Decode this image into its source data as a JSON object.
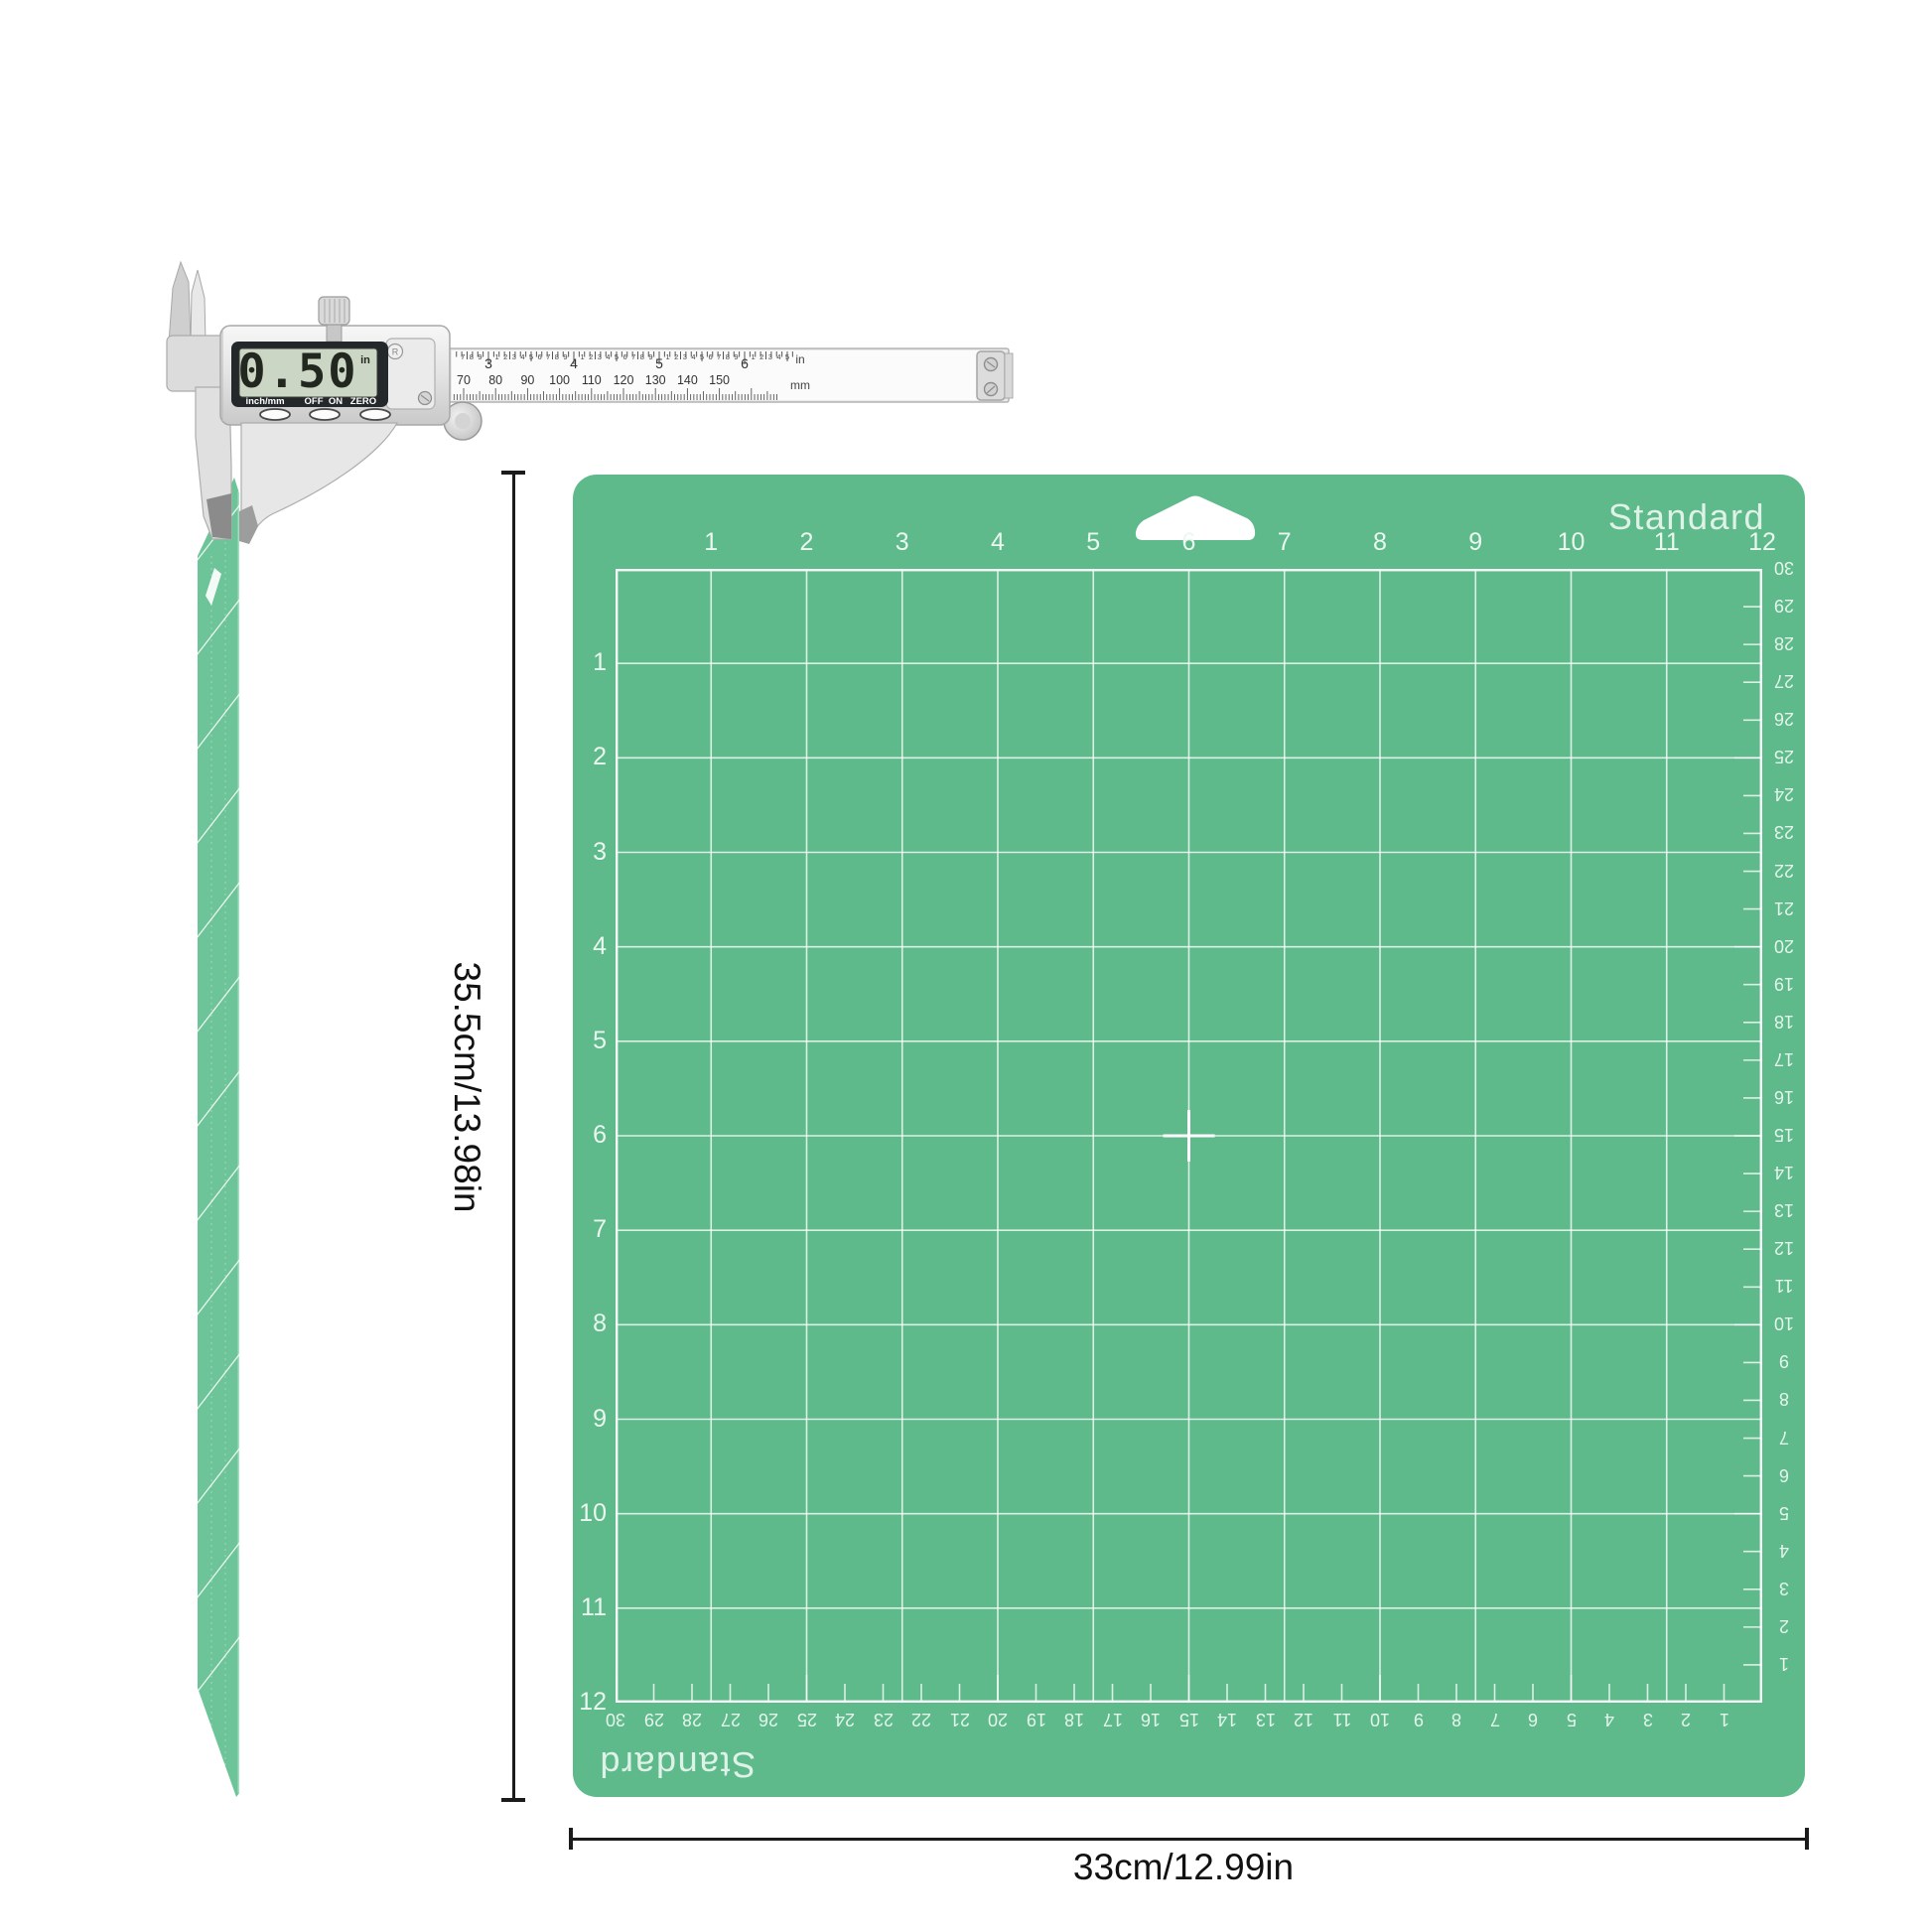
{
  "caliper": {
    "display_value": "0.50",
    "display_unit": "in",
    "button_labels": [
      "inch/mm",
      "OFF",
      "ON",
      "ZERO"
    ],
    "registered_mark": "R",
    "inch_scale": {
      "numbers": [
        3,
        4,
        5,
        6
      ],
      "tenth_digits": [
        1,
        2,
        3,
        4,
        5,
        6,
        7,
        8,
        9
      ],
      "unit_label": "in"
    },
    "mm_scale": {
      "numbers": [
        70,
        80,
        90,
        100,
        110,
        120,
        130,
        140,
        150
      ],
      "unit_label": "mm"
    }
  },
  "mat": {
    "color": "#5eb98b",
    "side_color": "#6cc498",
    "grid_line_color": "rgba(255,255,255,0.78)",
    "brand_label_top": "Standard",
    "brand_label_bottom": "Standard",
    "column_numbers": [
      1,
      2,
      3,
      4,
      5,
      6,
      7,
      8,
      9,
      10,
      11,
      12
    ],
    "row_numbers": [
      1,
      2,
      3,
      4,
      5,
      6,
      7,
      8,
      9,
      10,
      11,
      12
    ],
    "cm_numbers_right": [
      30,
      29,
      28,
      27,
      26,
      25,
      24,
      23,
      22,
      21,
      20,
      19,
      18,
      17,
      16,
      15,
      14,
      13,
      12,
      11,
      10,
      9,
      8,
      7,
      6,
      5,
      4,
      3,
      2,
      1
    ],
    "cm_numbers_bottom": [
      30,
      29,
      28,
      27,
      26,
      25,
      24,
      23,
      22,
      21,
      20,
      19,
      18,
      17,
      16,
      15,
      14,
      13,
      12,
      11,
      10,
      9,
      8,
      7,
      6,
      5,
      4,
      3,
      2,
      1
    ]
  },
  "annotations": {
    "height_label": "35.5cm/13.98in",
    "width_label": "33cm/12.99in"
  }
}
